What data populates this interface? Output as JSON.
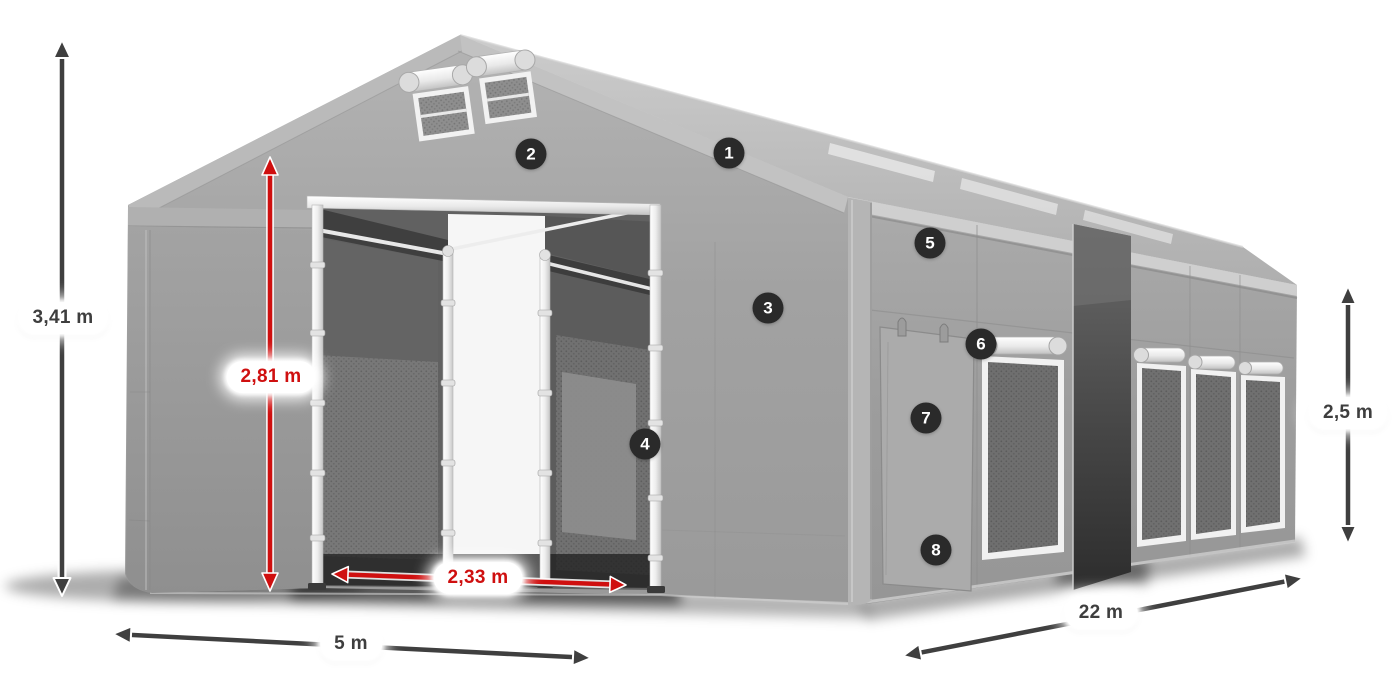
{
  "figure": {
    "type": "product-dimension-diagram",
    "subject": "storage tent hall with open entrance, side doors and mesh windows"
  },
  "colors": {
    "background": "#ffffff",
    "accent_red": "#cf0f0f",
    "arrow_dark": "#3f3f3f",
    "badge_background": "#2a2a2a",
    "badge_text": "#ffffff",
    "tent_gray": "#9e9e9e",
    "label_text_dark": "#3e3e3e"
  },
  "dimensions": {
    "total_height": {
      "label": "3,41 m",
      "style": "dark",
      "orientation": "vertical"
    },
    "entrance_height": {
      "label": "2,81 m",
      "style": "red",
      "orientation": "vertical"
    },
    "entrance_width": {
      "label": "2,33 m",
      "style": "red",
      "orientation": "horizontal"
    },
    "front_width": {
      "label": "5 m",
      "style": "dark",
      "orientation": "horizontal"
    },
    "side_length": {
      "label": "22 m",
      "style": "dark",
      "orientation": "diagonal"
    },
    "side_wall_height": {
      "label": "2,5 m",
      "style": "dark",
      "orientation": "vertical"
    }
  },
  "callouts": [
    {
      "number": "1"
    },
    {
      "number": "2"
    },
    {
      "number": "3"
    },
    {
      "number": "4"
    },
    {
      "number": "5"
    },
    {
      "number": "6"
    },
    {
      "number": "7"
    },
    {
      "number": "8"
    }
  ]
}
